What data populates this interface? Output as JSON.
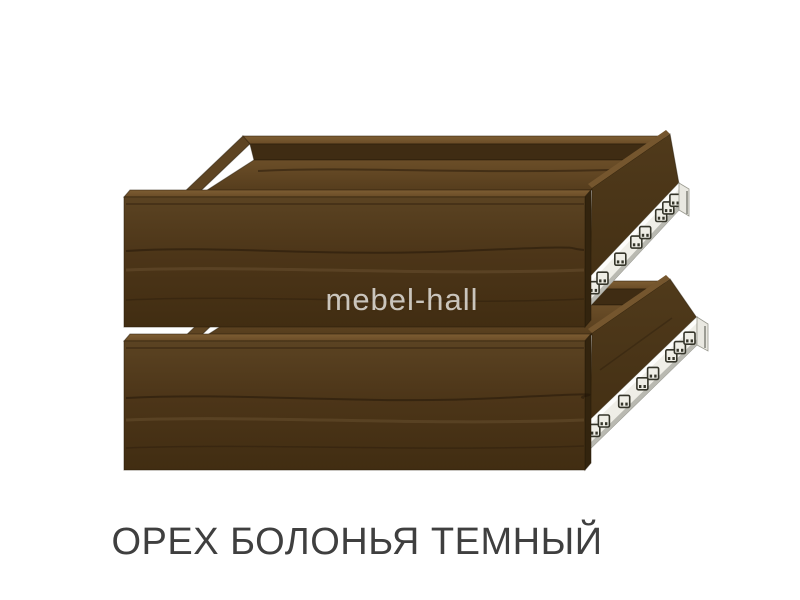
{
  "page": {
    "background_color": "#ffffff"
  },
  "watermark": {
    "text": "mebel-hall",
    "color": "#e2dfda"
  },
  "caption": {
    "text": "ОРЕХ БОЛОНЬЯ ТЕМНЫЙ",
    "color": "#3f3f3f"
  },
  "product": {
    "kind": "drawer boxes with telescopic ball-bearing slides",
    "drawer_count": 2,
    "finish_name": "ОРЕХ БОЛОНЬЯ ТЕМНЫЙ",
    "colors": {
      "wood_front": "#4c3518",
      "wood_top_edge": "#75562e",
      "wood_interior": "#5d4322",
      "wood_dark_edge": "#241806",
      "rail_body": "#efeee7",
      "rail_highlight": "#fdfdfb",
      "rail_shadow": "#b9b9b1",
      "slot_outline": "#35352a"
    }
  }
}
